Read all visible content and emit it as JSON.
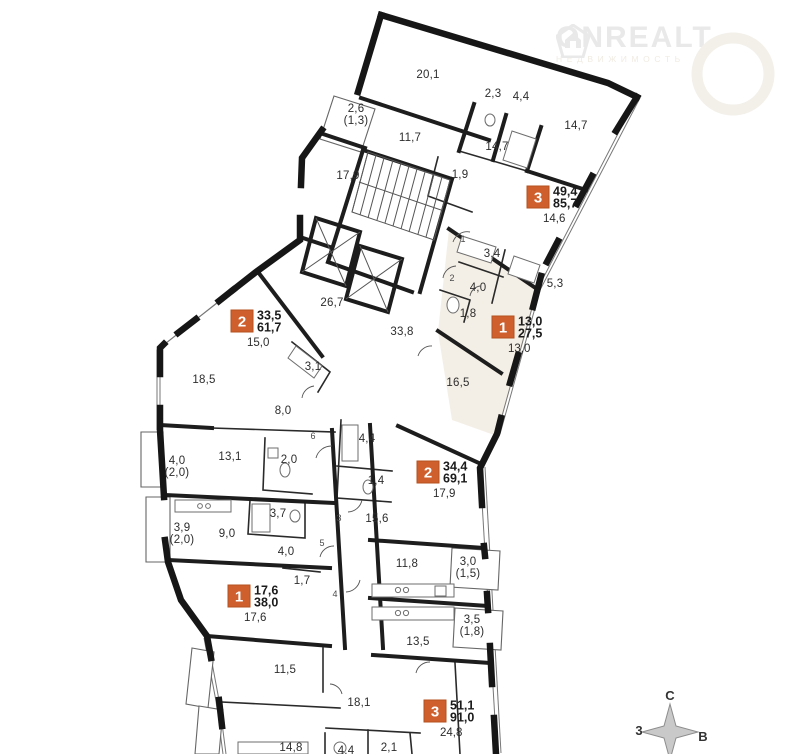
{
  "logo": {
    "name": "ONREALT",
    "subtitle": "НЕДВИЖИМОСТЬ",
    "color": "#e9e9e9"
  },
  "plan": {
    "wall_color": "#161616",
    "highlight_color": "#f4efe6",
    "accent_color": "#cf5f2d",
    "room_labels": [
      {
        "t": "20,1",
        "x": 428,
        "y": 78
      },
      {
        "t": "2,3",
        "x": 493,
        "y": 97
      },
      {
        "t": "4,4",
        "x": 521,
        "y": 100
      },
      {
        "t": "14,7",
        "x": 576,
        "y": 129
      },
      {
        "t": "2,6",
        "s": "(1,3)",
        "x": 356,
        "y": 112
      },
      {
        "t": "11,7",
        "x": 410,
        "y": 141
      },
      {
        "t": "14,7",
        "x": 497,
        "y": 150
      },
      {
        "t": "17,9",
        "x": 348,
        "y": 179
      },
      {
        "t": "1,9",
        "x": 460,
        "y": 178
      },
      {
        "t": "3,4",
        "x": 492,
        "y": 257
      },
      {
        "t": "4,0",
        "x": 478,
        "y": 291
      },
      {
        "t": "5,3",
        "x": 555,
        "y": 287
      },
      {
        "t": "1,8",
        "x": 468,
        "y": 317
      },
      {
        "t": "26,7",
        "x": 332,
        "y": 306
      },
      {
        "t": "33,8",
        "x": 402,
        "y": 335
      },
      {
        "t": "3,1",
        "x": 313,
        "y": 370
      },
      {
        "t": "18,5",
        "x": 204,
        "y": 383
      },
      {
        "t": "16,5",
        "x": 458,
        "y": 386
      },
      {
        "t": "8,0",
        "x": 283,
        "y": 414
      },
      {
        "t": "4,4",
        "x": 367,
        "y": 442
      },
      {
        "t": "13,1",
        "x": 230,
        "y": 460
      },
      {
        "t": "2,0",
        "x": 289,
        "y": 463
      },
      {
        "t": "4,0",
        "s": "(2,0)",
        "x": 177,
        "y": 464
      },
      {
        "t": "1,4",
        "x": 376,
        "y": 484
      },
      {
        "t": "3,7",
        "x": 278,
        "y": 517
      },
      {
        "t": "15,6",
        "x": 377,
        "y": 522
      },
      {
        "t": "3,9",
        "s": "(2,0)",
        "x": 182,
        "y": 531
      },
      {
        "t": "9,0",
        "x": 227,
        "y": 537
      },
      {
        "t": "4,0",
        "x": 286,
        "y": 555
      },
      {
        "t": "11,8",
        "x": 407,
        "y": 567
      },
      {
        "t": "3,0",
        "s": "(1,5)",
        "x": 468,
        "y": 565
      },
      {
        "t": "1,7",
        "x": 302,
        "y": 584
      },
      {
        "t": "3,5",
        "s": "(1,8)",
        "x": 472,
        "y": 623
      },
      {
        "t": "13,5",
        "x": 418,
        "y": 645
      },
      {
        "t": "11,5",
        "x": 285,
        "y": 673
      },
      {
        "t": "18,1",
        "x": 359,
        "y": 706
      },
      {
        "t": "14,8",
        "x": 291,
        "y": 751
      },
      {
        "t": "4,4",
        "x": 346,
        "y": 754
      },
      {
        "t": "2,1",
        "x": 389,
        "y": 751
      }
    ],
    "apartments": [
      {
        "number": "3",
        "living_area": "49,4",
        "total_area": "85,7",
        "extra_area": "14,6",
        "x": 527,
        "y": 186
      },
      {
        "number": "2",
        "living_area": "33,5",
        "total_area": "61,7",
        "extra_area": "15,0",
        "x": 231,
        "y": 310
      },
      {
        "number": "1",
        "living_area": "13,0",
        "total_area": "27,5",
        "extra_area": "13,0",
        "x": 492,
        "y": 316
      },
      {
        "number": "2",
        "living_area": "34,4",
        "total_area": "69,1",
        "extra_area": "17,9",
        "x": 417,
        "y": 461
      },
      {
        "number": "1",
        "living_area": "17,6",
        "total_area": "38,0",
        "extra_area": "17,6",
        "x": 228,
        "y": 585
      },
      {
        "number": "3",
        "living_area": "51,1",
        "total_area": "91,0",
        "extra_area": "24,8",
        "x": 424,
        "y": 700
      }
    ],
    "door_numbers": [
      {
        "t": "1",
        "x": 463,
        "y": 242
      },
      {
        "t": "2",
        "x": 452,
        "y": 281
      },
      {
        "t": "6",
        "x": 313,
        "y": 439
      },
      {
        "t": "3",
        "x": 339,
        "y": 521
      },
      {
        "t": "5",
        "x": 322,
        "y": 546
      },
      {
        "t": "4",
        "x": 335,
        "y": 597
      }
    ]
  },
  "compass": {
    "north": "С",
    "east": "В",
    "west": "3",
    "cx": 670,
    "cy": 731
  }
}
